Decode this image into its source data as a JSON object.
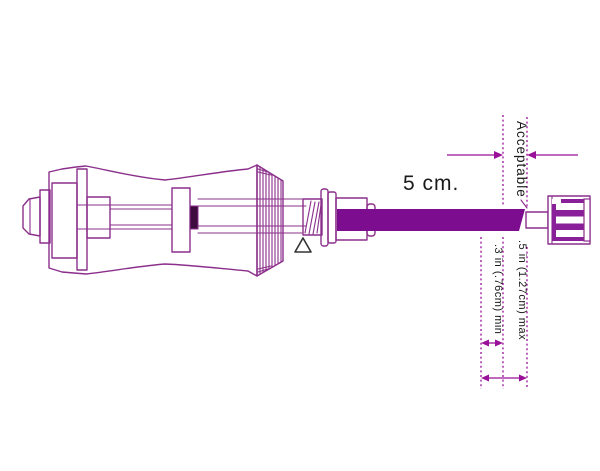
{
  "diagram": {
    "labels": {
      "tube_length": "5 cm.",
      "acceptable": "Acceptable",
      "max_dimension": ".5 in (1.27cm)  max",
      "min_dimension": ".3 in (.76cm) min"
    },
    "colors": {
      "line": "#8b2f8b",
      "tube_fill": "#7d0d8f",
      "connector_fill": "#8a1f9a",
      "dark_fill": "#3d0b3d",
      "dimension_line": "#991199",
      "label_text": "#1a1a1a"
    }
  }
}
